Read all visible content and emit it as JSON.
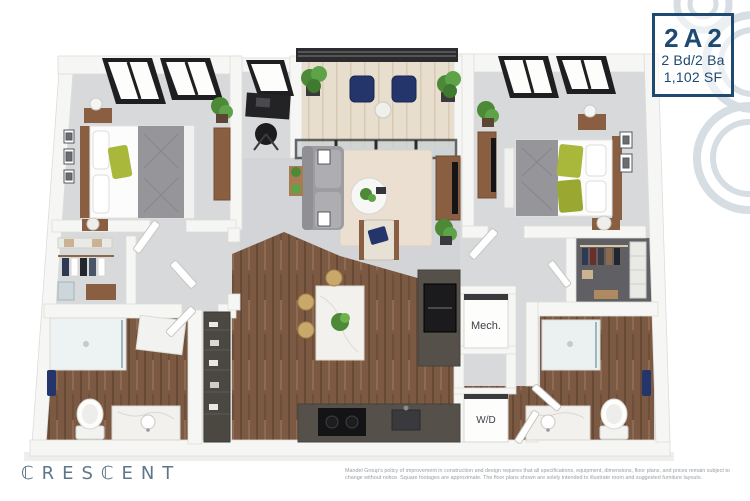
{
  "plan_badge": {
    "code": "2A2",
    "beds_baths": "2 Bd/2 Ba",
    "area": "1,102 SF",
    "border_color": "#1e4a72",
    "text_color": "#1e4a72"
  },
  "branding": {
    "logo_text": "ℂRESℂENT",
    "logo_color": "#5d7689"
  },
  "disclaimer": {
    "text": "Mandel Group's policy of improvement in construction and design requires that all specifications, equipment, dimensions, floor plans, and prices remain subject to change without notice. Square footages are approximate. The floor plans shown are solely intended to illustrate room and suggested furniture layouts.",
    "color": "#989ea3"
  },
  "floorplan": {
    "labels": {
      "mech": "Mech.",
      "wd": "W/D"
    },
    "palette": {
      "wall": "#f6f6f4",
      "carpet": "#d8d9db",
      "wood_floor": "#7b5942",
      "balcony_floor": "#e8decd",
      "marble": "#f3f1ed",
      "cabinet_dark": "#55514a",
      "appliance_black": "#1b1b1d",
      "accent_navy": "#24356b",
      "accent_green": "#a9b73a",
      "plant_green": "#4c8a38",
      "window_frame": "#1f1f21",
      "watermark": "#d6dee4"
    }
  }
}
